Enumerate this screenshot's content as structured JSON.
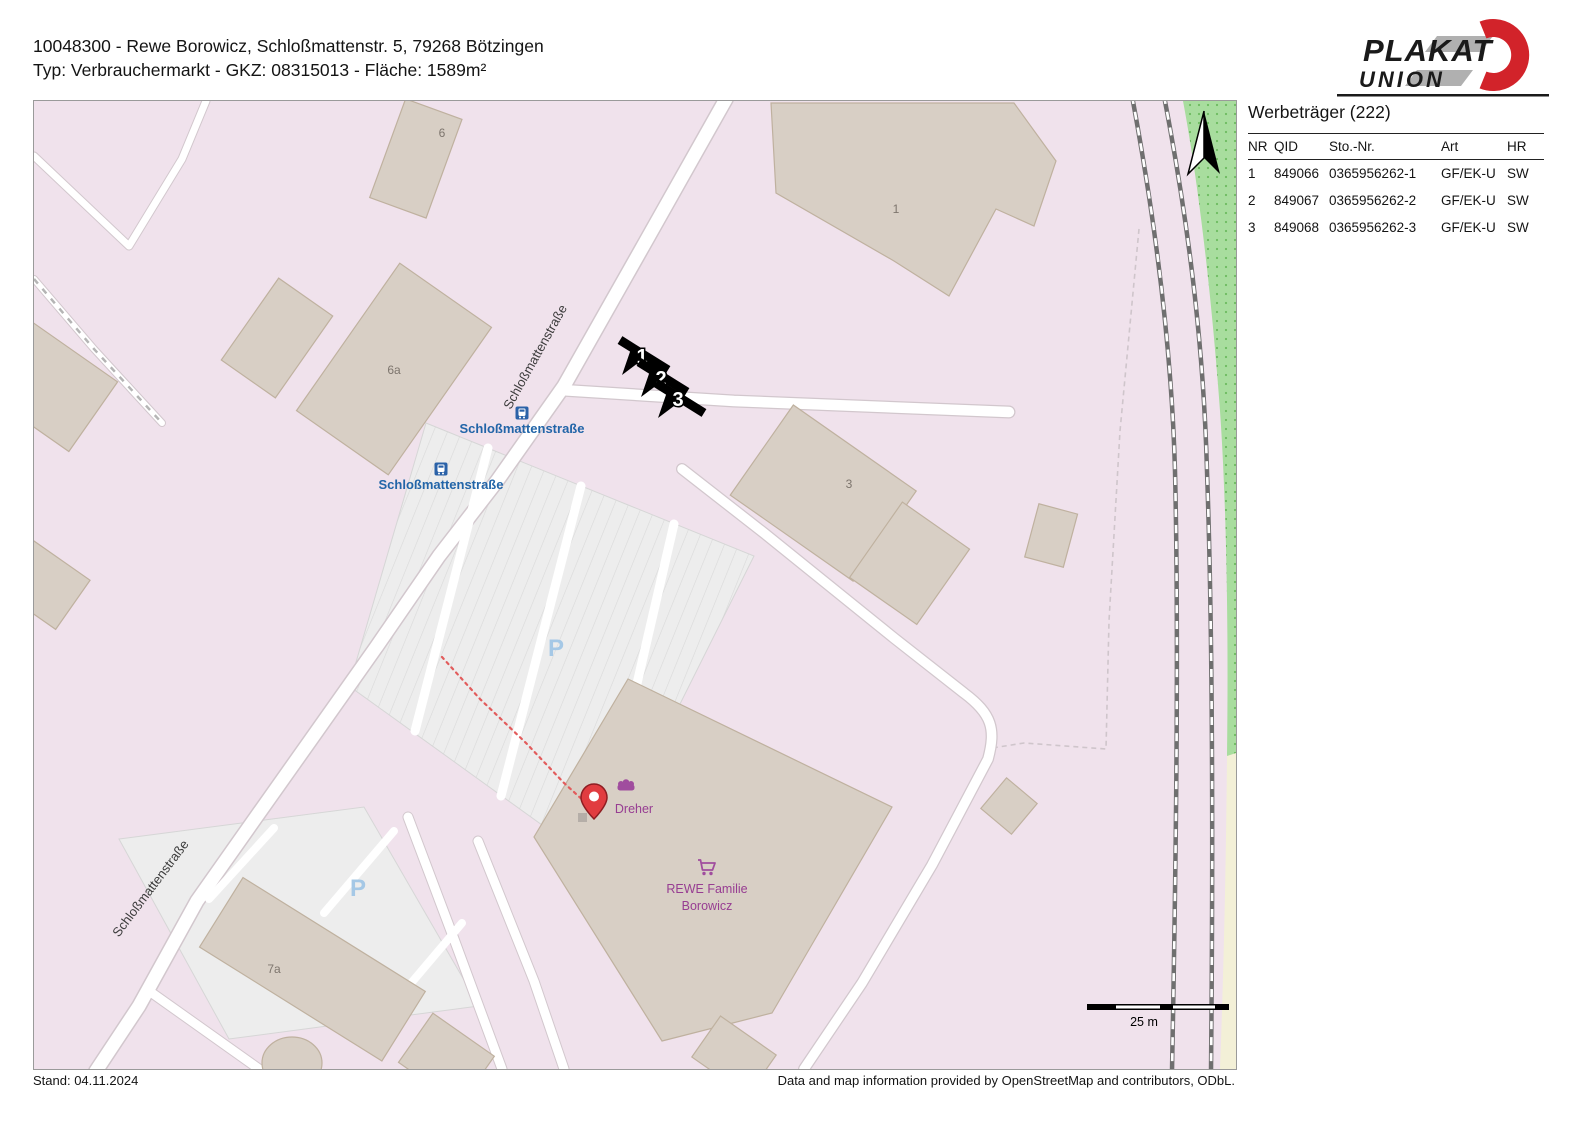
{
  "page": {
    "title_line1": "10048300 - Rewe Borowicz, Schloßmattenstr. 5, 79268 Bötzingen",
    "title_line2": "Typ: Verbrauchermarkt - GKZ: 08315013 - Fläche: 1589m²",
    "stand": "Stand: 04.11.2024",
    "attribution": "Data and map information provided by OpenStreetMap and contributors, ODbL."
  },
  "logo": {
    "line1": "PLAKAT",
    "line2": "UNION"
  },
  "sidebar": {
    "title": "Werbeträger (222)",
    "columns": [
      "NR",
      "QID",
      "Sto.-Nr.",
      "Art",
      "HR"
    ],
    "rows": [
      {
        "nr": "1",
        "qid": "849066",
        "sto": "0365956262-1",
        "art": "GF/EK-U",
        "hr": "SW"
      },
      {
        "nr": "2",
        "qid": "849067",
        "sto": "0365956262-2",
        "art": "GF/EK-U",
        "hr": "SW"
      },
      {
        "nr": "3",
        "qid": "849068",
        "sto": "0365956262-3",
        "art": "GF/EK-U",
        "hr": "SW"
      }
    ]
  },
  "map": {
    "street_label_top": "Schloßmattenstraße",
    "street_label_bottom": "Schloßmattenstraße",
    "bus_stop_1": "Schloßmattenstraße",
    "bus_stop_2": "Schloßmattenstraße",
    "building_labels": {
      "b6": "6",
      "b1": "1",
      "b6a": "6a",
      "b3": "3",
      "b7a": "7a"
    },
    "poi": {
      "bakery": "Dreher",
      "supermarket_line1": "REWE Familie",
      "supermarket_line2": "Borowicz"
    },
    "parking_label": "P",
    "scale_label": "25 m",
    "markers": [
      {
        "n": "1"
      },
      {
        "n": "2"
      },
      {
        "n": "3"
      }
    ]
  },
  "colors": {
    "map_background": "#f0e2ec",
    "building": "#d8cfc5",
    "green_area": "#a8dd9e",
    "yellow_area": "#f3f0d7",
    "road": "#ffffff",
    "railway": "#6f6f6f",
    "poi_purple": "#973d92",
    "bus_blue": "#2b62a8",
    "pin_red": "#e13c40",
    "logo_red": "#d2232a"
  }
}
